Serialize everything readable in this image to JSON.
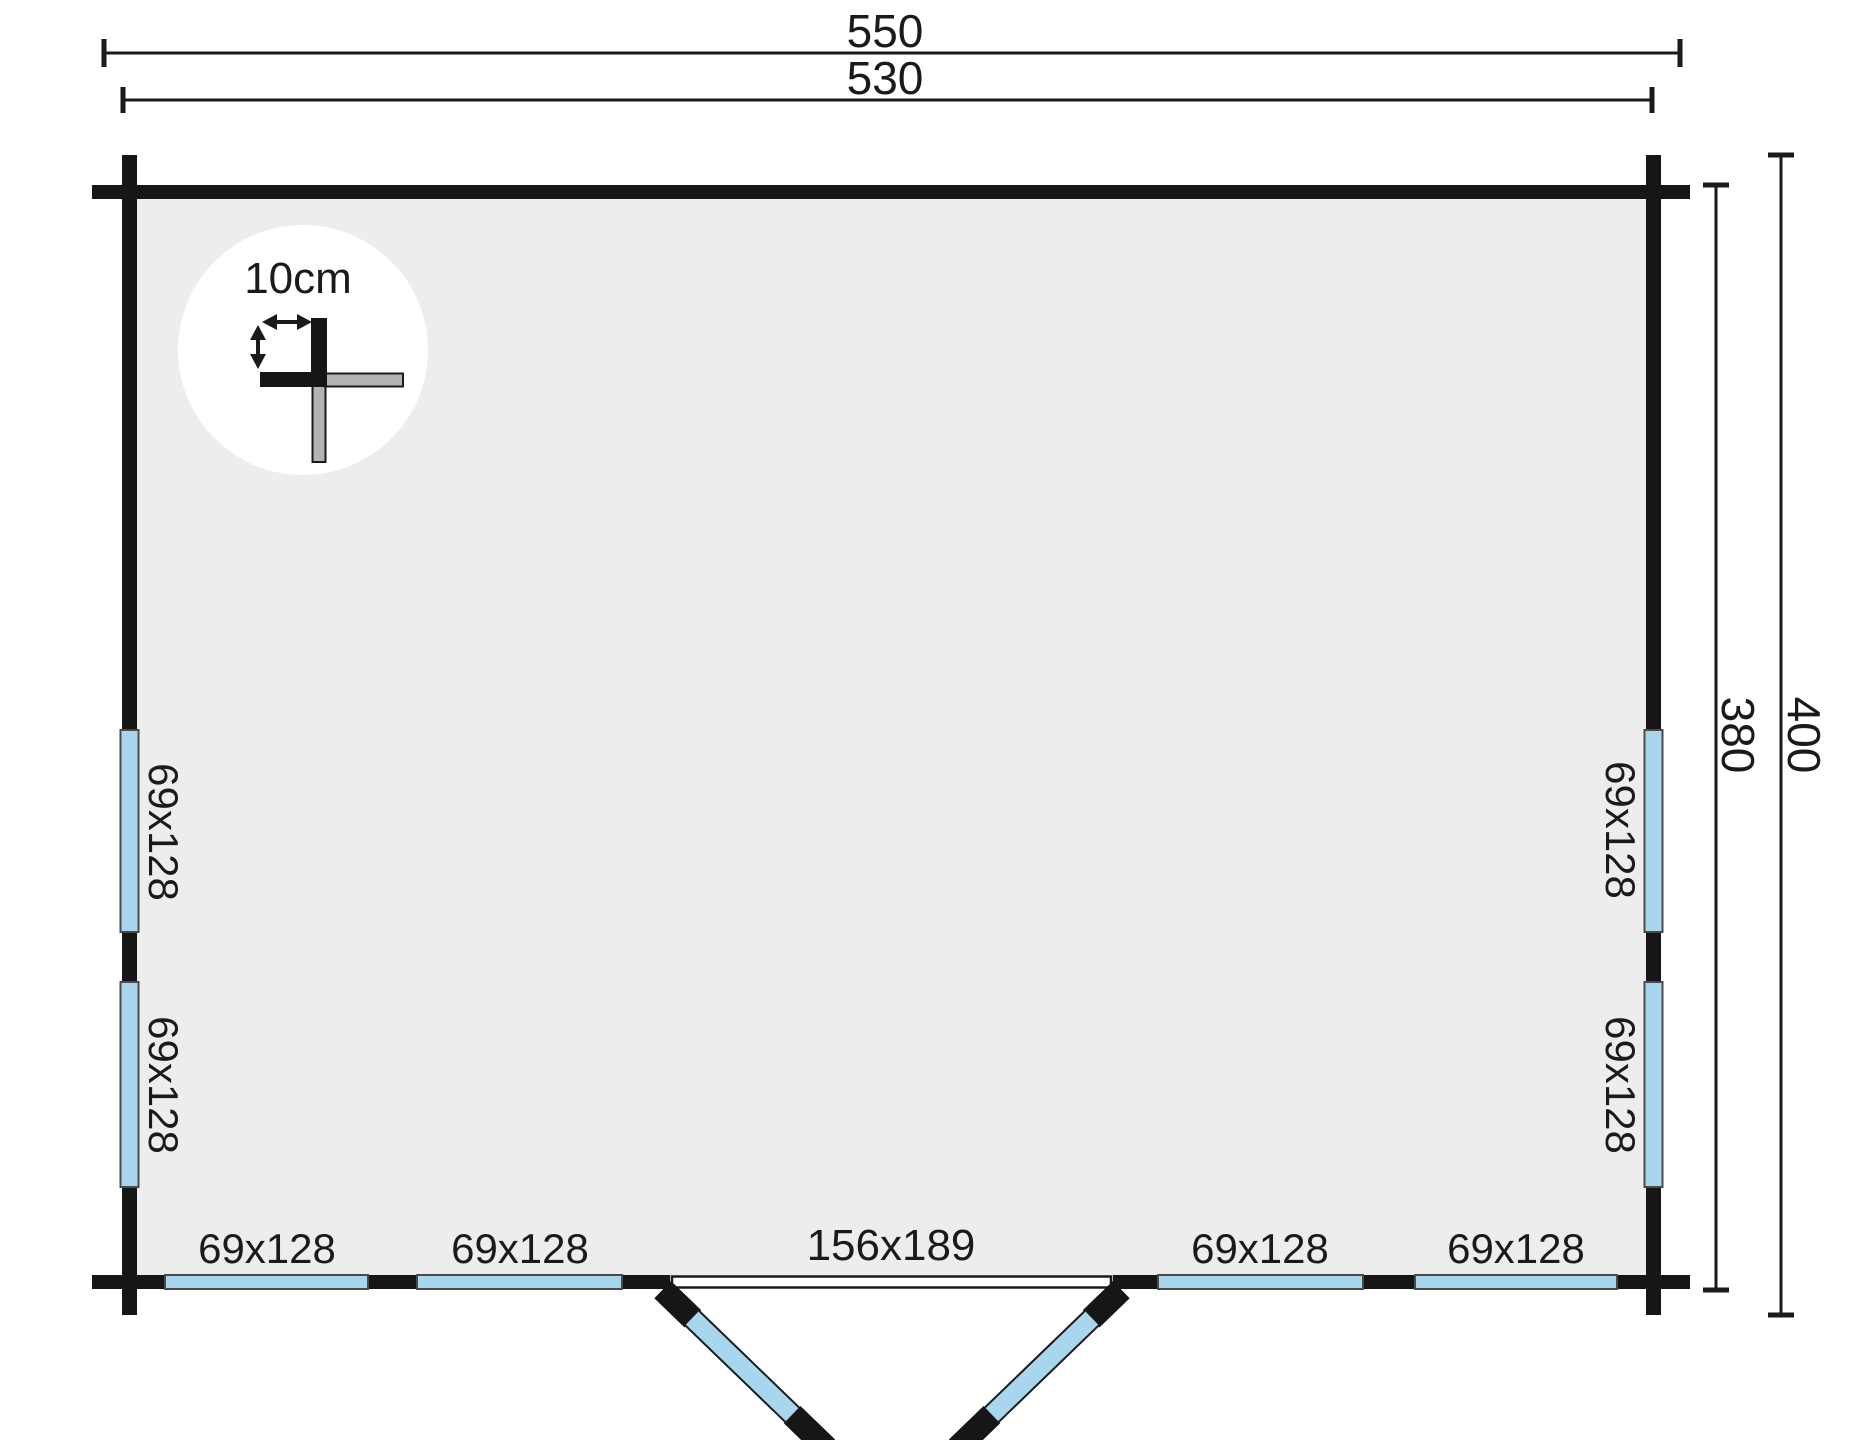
{
  "plan": {
    "name": "log-cabin-floor-plan",
    "dim_top_outer": "550",
    "dim_top_inner": "530",
    "dim_right_inner": "380",
    "dim_right_outer": "400",
    "detail_label": "10cm",
    "door_label": "156x189",
    "window_left_1": "69x128",
    "window_left_2": "69x128",
    "window_right_1": "69x128",
    "window_right_2": "69x128",
    "window_bottom_1": "69x128",
    "window_bottom_2": "69x128",
    "window_bottom_3": "69x128",
    "window_bottom_4": "69x128"
  },
  "colors": {
    "ink": "#1a1a1a",
    "wall": "#161616",
    "interior": "#ededed",
    "window": "#a9d6ef",
    "door_leaf": "#a9d6ef",
    "log_end_gray": "#b3b3b3",
    "detail_bg": "#ffffff"
  }
}
